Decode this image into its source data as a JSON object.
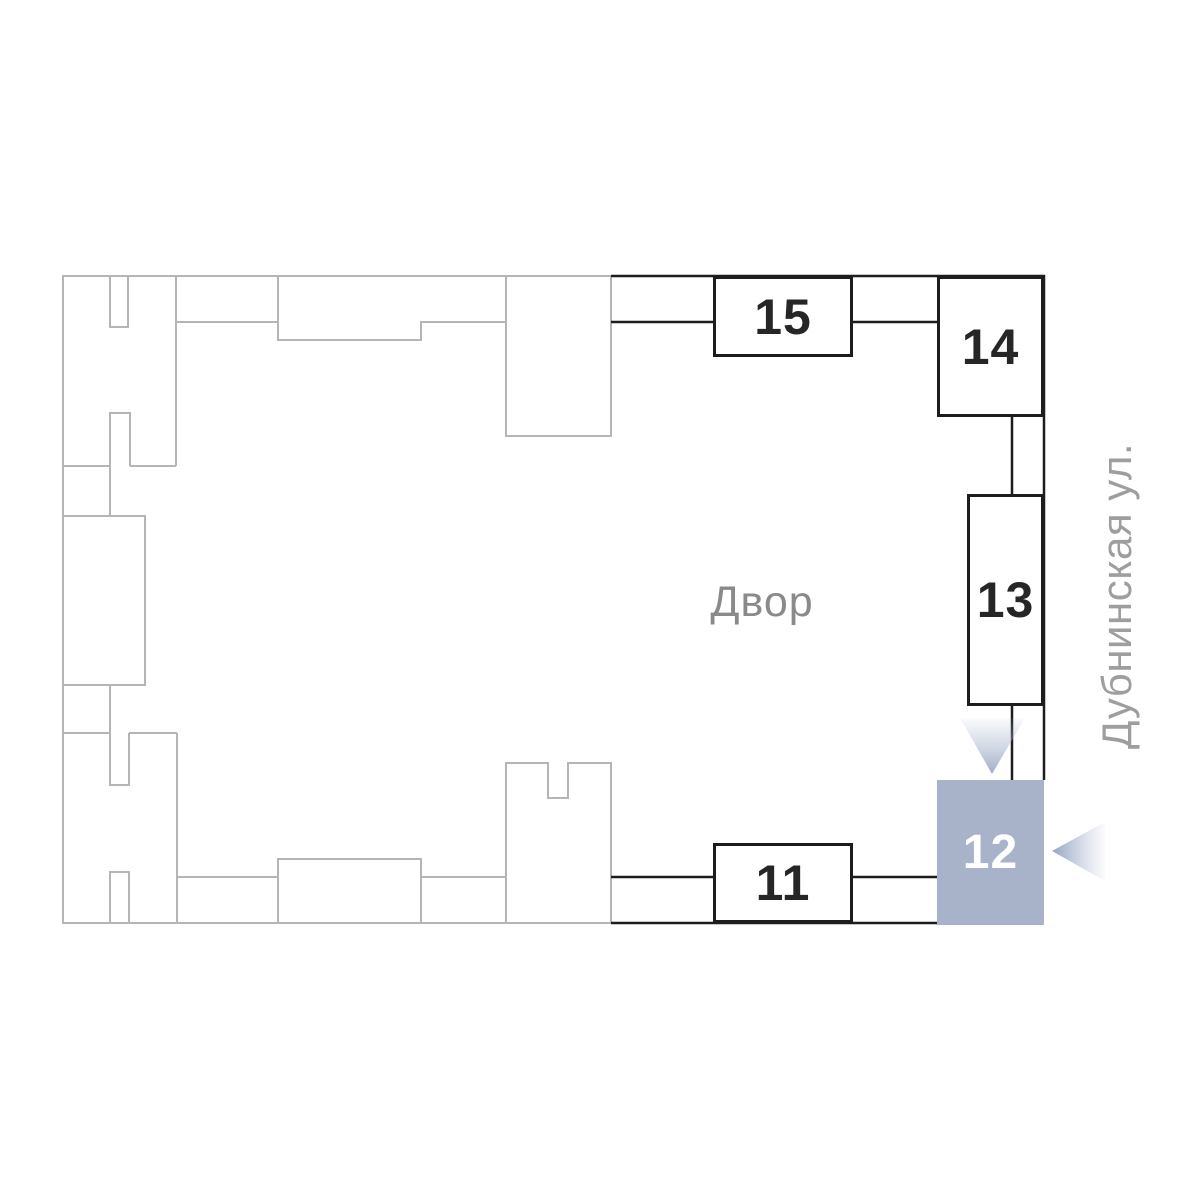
{
  "plan": {
    "title_context": "site plan building selector",
    "yard": {
      "label": "Двор"
    },
    "street": {
      "label": "Дубнинская ул."
    },
    "blocks": [
      {
        "id": "15",
        "label": "15",
        "state": "default"
      },
      {
        "id": "14",
        "label": "14",
        "state": "default"
      },
      {
        "id": "13",
        "label": "13",
        "state": "default"
      },
      {
        "id": "12",
        "label": "12",
        "state": "selected"
      },
      {
        "id": "11",
        "label": "11",
        "state": "default"
      }
    ],
    "colors": {
      "selected_fill": "#a8b3ca",
      "wall_dark": "#1d1d1d",
      "outline_gray": "#b5b5b5",
      "yard_text": "#8a8a8a",
      "street_text": "#9e9e9e",
      "number_dark": "#262626",
      "number_selected": "#ffffff",
      "arrow": "#9fadc9"
    }
  }
}
